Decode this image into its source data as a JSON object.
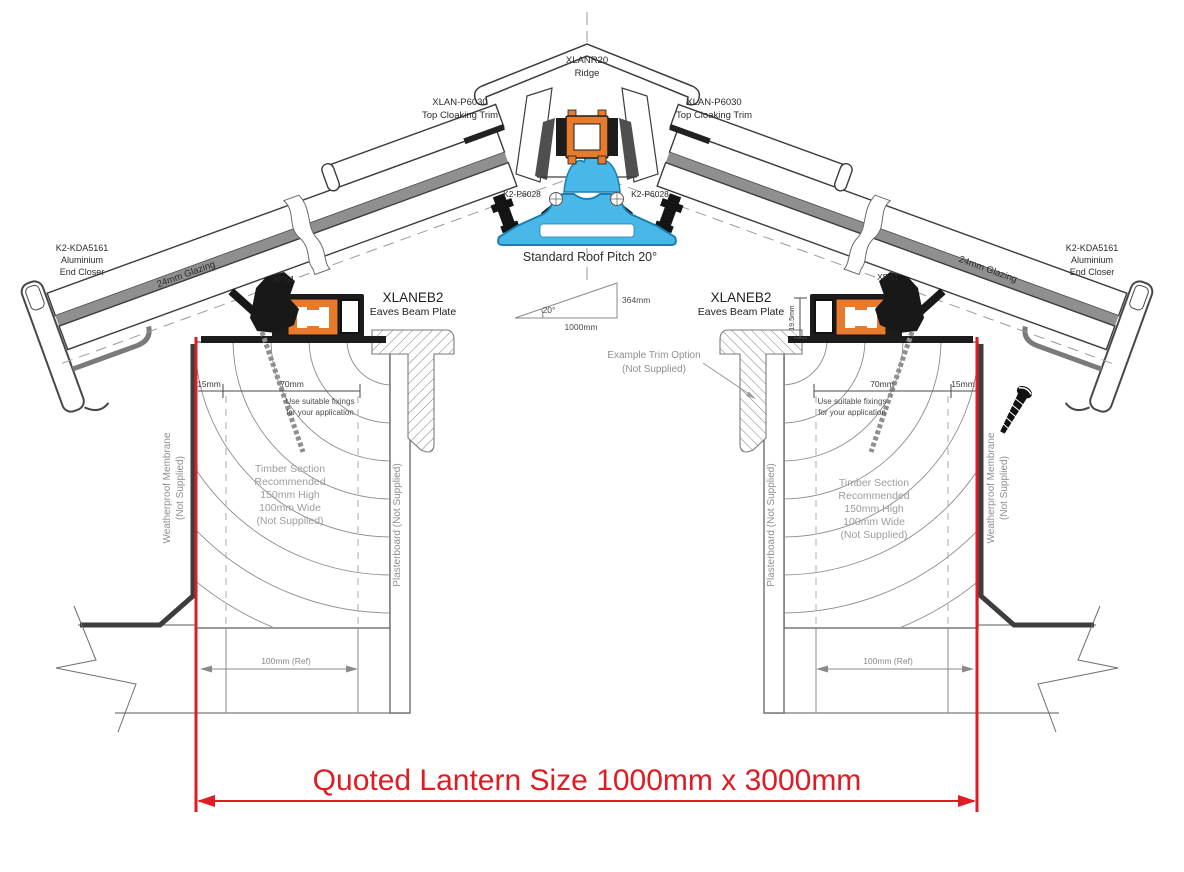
{
  "diagram": {
    "title": "Roof lantern cross section installation detail",
    "ridge": {
      "code": "XLANR20",
      "name": "Ridge"
    },
    "top_cloaking": {
      "code": "XLAN-P6030",
      "name": "Top Cloaking Trim"
    },
    "ridge_clamp": {
      "code": "K2-P6028"
    },
    "pitch": {
      "label": "Standard Roof Pitch 20°",
      "angle": "20°",
      "rise": "364mm",
      "run": "1000mm"
    },
    "end_closer": {
      "code": "K2-KDA5161",
      "line2": "Aluminium",
      "line3": "End Closer"
    },
    "glazing": {
      "label": "24mm Glazing"
    },
    "xps_clip": {
      "code": "XPS1"
    },
    "eaves_beam": {
      "code": "XLANEB2",
      "name": "Eaves Beam Plate",
      "upstand_height": "19.5mm"
    },
    "trim_option": {
      "line1": "Example Trim Option",
      "line2": "(Not Supplied)"
    },
    "timber": {
      "lines": [
        "Timber Section",
        "Recommended",
        "150mm High",
        "100mm Wide",
        "(Not Supplied)"
      ],
      "dim_edge": "15mm",
      "dim_fixing_zone": "70mm",
      "fixing_note1": "Use suitable fixings",
      "fixing_note2": "for your application",
      "ref_width": "100mm (Ref)"
    },
    "membrane": {
      "line1": "Weatherproof Membrane",
      "line2": "(Not Supplied)"
    },
    "plasterboard": {
      "label": "Plasterboard (Not Supplied)"
    },
    "quoted_size": {
      "label": "Quoted Lantern Size 1000mm x 3000mm"
    },
    "colors": {
      "accent_red": "#e01b24",
      "thermal_break_orange": "#e87a2e",
      "ridge_body_blue": "#49b8e8"
    }
  }
}
